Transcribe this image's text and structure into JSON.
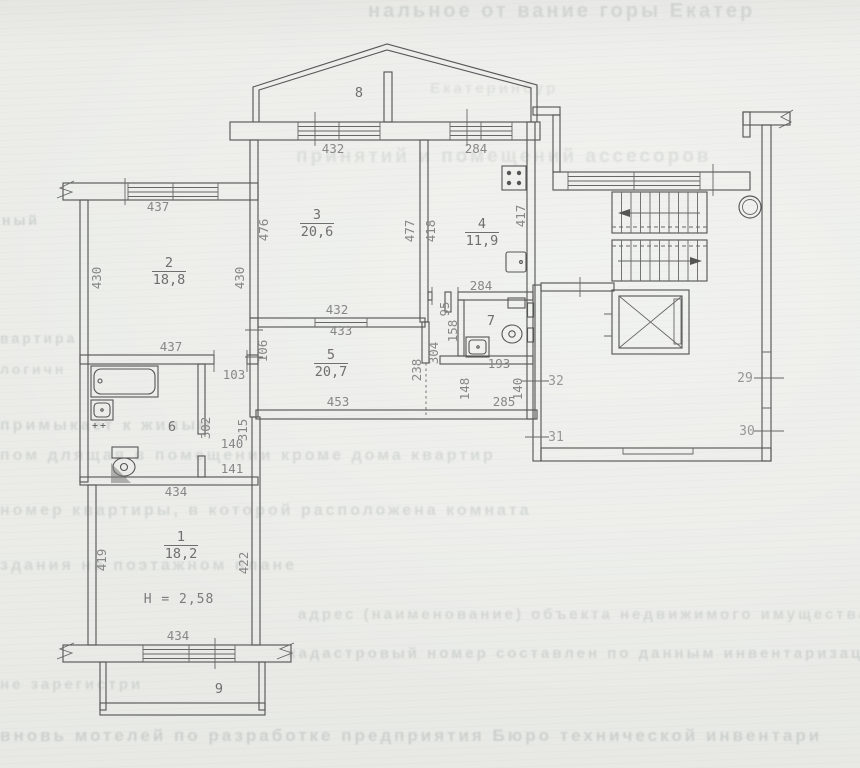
{
  "colors": {
    "paper": "#ebece8",
    "ink": "#585858",
    "dim_text": "#878787",
    "room_text": "#6f6f6f",
    "ghost_text": "#78837f"
  },
  "plan": {
    "rooms": [
      {
        "num": "1",
        "area": "18,2",
        "x": 181,
        "y": 541
      },
      {
        "num": "2",
        "area": "18,8",
        "x": 169,
        "y": 267
      },
      {
        "num": "3",
        "area": "20,6",
        "x": 317,
        "y": 219
      },
      {
        "num": "4",
        "area": "11,9",
        "x": 482,
        "y": 228
      },
      {
        "num": "5",
        "area": "20,7",
        "x": 331,
        "y": 359
      },
      {
        "num": "6",
        "x": 172,
        "y": 431
      },
      {
        "num": "7",
        "x": 491,
        "y": 325
      },
      {
        "num": "8",
        "x": 359,
        "y": 97
      },
      {
        "num": "9",
        "x": 219,
        "y": 693
      }
    ],
    "height_note": {
      "text": "H = 2,58",
      "x": 179,
      "y": 603
    },
    "dims": [
      {
        "t": "437",
        "x": 158,
        "y": 211
      },
      {
        "t": "432",
        "x": 333,
        "y": 153
      },
      {
        "t": "284",
        "x": 476,
        "y": 153
      },
      {
        "t": "437",
        "x": 171,
        "y": 351
      },
      {
        "t": "432",
        "x": 337,
        "y": 314
      },
      {
        "t": "433",
        "x": 341,
        "y": 335
      },
      {
        "t": "103",
        "x": 234,
        "y": 379
      },
      {
        "t": "140",
        "x": 232,
        "y": 448
      },
      {
        "t": "141",
        "x": 232,
        "y": 473
      },
      {
        "t": "434",
        "x": 176,
        "y": 496
      },
      {
        "t": "434",
        "x": 178,
        "y": 640
      },
      {
        "t": "453",
        "x": 338,
        "y": 406
      },
      {
        "t": "285",
        "x": 504,
        "y": 406
      },
      {
        "t": "193",
        "x": 499,
        "y": 368
      },
      {
        "t": "284",
        "x": 481,
        "y": 290
      },
      {
        "t": "430",
        "x": 101,
        "y": 278,
        "r": 1
      },
      {
        "t": "430",
        "x": 244,
        "y": 278,
        "r": 1
      },
      {
        "t": "476",
        "x": 268,
        "y": 230,
        "r": 1
      },
      {
        "t": "477",
        "x": 414,
        "y": 231,
        "r": 1
      },
      {
        "t": "418",
        "x": 435,
        "y": 231,
        "r": 1
      },
      {
        "t": "417",
        "x": 525,
        "y": 216,
        "r": 1
      },
      {
        "t": "106",
        "x": 267,
        "y": 351,
        "r": 1
      },
      {
        "t": "302",
        "x": 210,
        "y": 428,
        "r": 1
      },
      {
        "t": "315",
        "x": 247,
        "y": 430,
        "r": 1
      },
      {
        "t": "419",
        "x": 106,
        "y": 560,
        "r": 1
      },
      {
        "t": "422",
        "x": 248,
        "y": 563,
        "r": 1
      },
      {
        "t": "238",
        "x": 421,
        "y": 370,
        "r": 1
      },
      {
        "t": "304",
        "x": 438,
        "y": 353,
        "r": 1
      },
      {
        "t": "148",
        "x": 469,
        "y": 389,
        "r": 1
      },
      {
        "t": "140",
        "x": 522,
        "y": 389,
        "r": 1
      },
      {
        "t": "95",
        "x": 449,
        "y": 309,
        "r": 1,
        "s": 10
      },
      {
        "t": "158",
        "x": 457,
        "y": 331,
        "r": 1
      },
      {
        "t": "32",
        "x": 556,
        "y": 385,
        "k": "door"
      },
      {
        "t": "31",
        "x": 556,
        "y": 441,
        "k": "door"
      },
      {
        "t": "29",
        "x": 745,
        "y": 382,
        "k": "door"
      },
      {
        "t": "30",
        "x": 747,
        "y": 435,
        "k": "door"
      }
    ]
  },
  "ghost": {
    "lines": [
      {
        "t": "нальное от  вание горы Екатер",
        "x": 368,
        "y": 0,
        "s": 20,
        "o": 0.2
      },
      {
        "t": "Екатеринбур",
        "x": 430,
        "y": 80,
        "s": 15,
        "o": 0.13
      },
      {
        "t": "принятий и помещений ассесоров",
        "x": 296,
        "y": 146,
        "s": 19,
        "o": 0.15
      },
      {
        "t": "ный",
        "x": 2,
        "y": 212,
        "s": 14,
        "o": 0.25
      },
      {
        "t": "вартира",
        "x": 0,
        "y": 330,
        "s": 14,
        "o": 0.22
      },
      {
        "t": "логичн",
        "x": 0,
        "y": 361,
        "s": 14,
        "o": 0.2
      },
      {
        "t": "примыкает к жилым",
        "x": 0,
        "y": 417,
        "s": 16,
        "o": 0.22
      },
      {
        "t": "пом длящая в помещении кроме дома  квартир",
        "x": 0,
        "y": 447,
        "s": 16,
        "o": 0.2
      },
      {
        "t": "номер квартиры, в которой расположена комната",
        "x": 0,
        "y": 502,
        "s": 16,
        "o": 0.2
      },
      {
        "t": "здания на поэтажном плане",
        "x": 0,
        "y": 557,
        "s": 16,
        "o": 0.2
      },
      {
        "t": "адрес (наименование) объекта недвижимого имущества",
        "x": 298,
        "y": 606,
        "s": 15,
        "o": 0.2
      },
      {
        "t": "кадастровый номер составлен по данным инвентаризации на 27 апреля 2004 г",
        "x": 288,
        "y": 645,
        "s": 15,
        "o": 0.22
      },
      {
        "t": "не зарегистри",
        "x": 0,
        "y": 676,
        "s": 15,
        "o": 0.2
      },
      {
        "t": "вновь мотелей  по разработке предприятия Бюро технической инвентари",
        "x": 0,
        "y": 726,
        "s": 17,
        "o": 0.24
      }
    ]
  }
}
